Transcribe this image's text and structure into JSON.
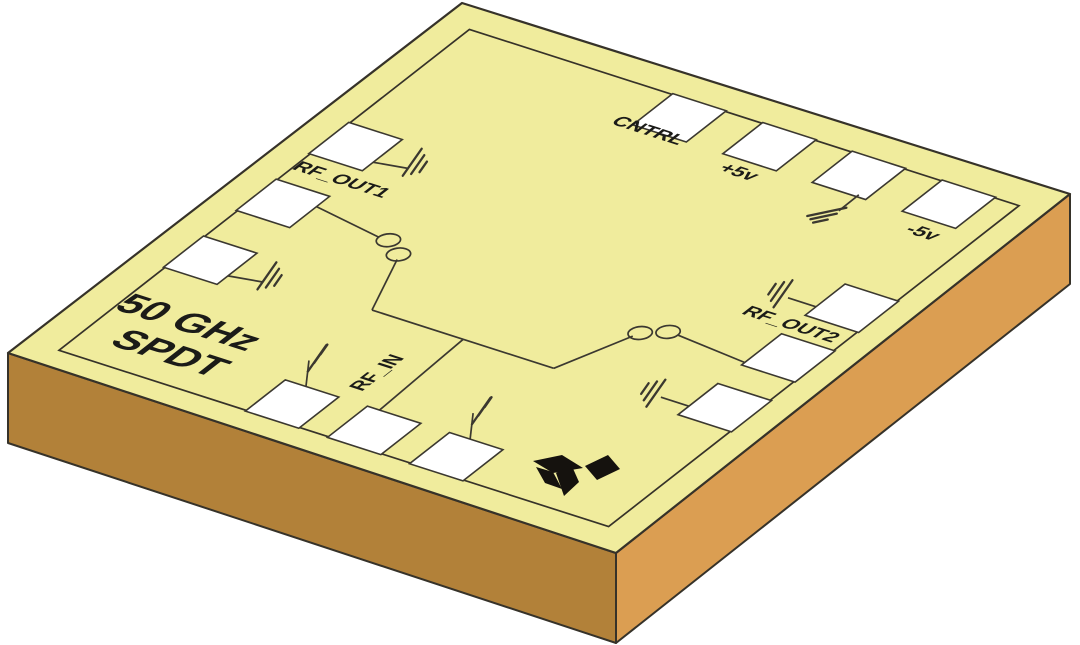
{
  "illustration": {
    "description": "Isometric rendering of a 50 GHz SPDT switch MMIC die on an orange substrate",
    "colors": {
      "background": "#ffffff",
      "die_top": "#f0ec9d",
      "substrate_left": "#b28139",
      "substrate_right": "#db9e52",
      "outline": "#363229",
      "pad_fill": "#ffffff",
      "pad_stroke": "#3b3830",
      "trace": "#3b3830",
      "text": "#1b1b18",
      "logo": "#15120e"
    },
    "die": {
      "top_face": [
        [
          462,
          3
        ],
        [
          1070,
          194
        ],
        [
          616,
          553
        ],
        [
          8,
          353
        ]
      ],
      "left_face": [
        [
          8,
          353
        ],
        [
          616,
          553
        ],
        [
          616,
          643
        ],
        [
          8,
          443
        ]
      ],
      "right_face": [
        [
          616,
          553
        ],
        [
          1070,
          194
        ],
        [
          1070,
          284
        ],
        [
          616,
          643
        ]
      ],
      "plane_matrix": [
        0.608,
        0.195,
        -0.454,
        0.355,
        462,
        3
      ],
      "border_inset": 48,
      "pad_size": 88,
      "circle_radius": 16
    },
    "pads": [
      {
        "id": "pad-cntrl",
        "edge": "top",
        "a": 425,
        "b": 90
      },
      {
        "id": "pad-plus5v",
        "edge": "top",
        "a": 573,
        "b": 90
      },
      {
        "id": "pad-gnd-top",
        "edge": "top",
        "a": 720,
        "b": 90
      },
      {
        "id": "pad-minus5v",
        "edge": "top",
        "a": 868,
        "b": 90
      },
      {
        "id": "pad-gnd-left-1",
        "edge": "left",
        "a": 90,
        "b": 355
      },
      {
        "id": "pad-rf-out1",
        "edge": "left",
        "a": 90,
        "b": 515
      },
      {
        "id": "pad-gnd-left-2",
        "edge": "left",
        "a": 90,
        "b": 675
      },
      {
        "id": "pad-gnd-bottom-1",
        "edge": "bottom",
        "a": 400,
        "b": 910
      },
      {
        "id": "pad-rf-in",
        "edge": "bottom",
        "a": 535,
        "b": 910
      },
      {
        "id": "pad-gnd-bottom-2",
        "edge": "bottom",
        "a": 670,
        "b": 910
      },
      {
        "id": "pad-gnd-right-1",
        "edge": "right",
        "a": 910,
        "b": 360
      },
      {
        "id": "pad-rf-out2",
        "edge": "right",
        "a": 910,
        "b": 500
      },
      {
        "id": "pad-gnd-right-2",
        "edge": "right",
        "a": 910,
        "b": 640
      }
    ],
    "labels": [
      {
        "id": "label-cntrl",
        "text": "CNTRL",
        "a": 408,
        "b": 137,
        "size": 33
      },
      {
        "id": "label-plus5v",
        "text": "+5v",
        "a": 575,
        "b": 162,
        "size": 33
      },
      {
        "id": "label-minus5v",
        "text": "-5v",
        "a": 880,
        "b": 165,
        "size": 33
      },
      {
        "id": "label-rf-out1",
        "text": "RF_OUT1",
        "a": 123,
        "b": 432,
        "size": 33
      },
      {
        "id": "label-rf-out2",
        "text": "RF_OUT2",
        "a": 863,
        "b": 433,
        "size": 33
      },
      {
        "id": "label-rf-in",
        "text": "RF_IN",
        "a": 454,
        "b": 793,
        "size": 33,
        "rotate": -90
      },
      {
        "id": "title-line-1",
        "text": "50 GHz",
        "a": 158,
        "b": 817,
        "size": 65
      },
      {
        "id": "title-line-2",
        "text": "SPDT",
        "a": 182,
        "b": 891,
        "size": 65
      }
    ],
    "switch_circuit": {
      "traces": [
        {
          "id": "trace-rfout1-to-contact",
          "pts": [
            [
              134,
              500
            ],
            [
              252,
              521
            ]
          ]
        },
        {
          "id": "trace-contact1-drop",
          "pts": [
            [
              307,
              554
            ],
            [
              353,
              671
            ]
          ]
        },
        {
          "id": "trace-bus",
          "pts": [
            [
              353,
              671
            ],
            [
              652,
              671
            ]
          ]
        },
        {
          "id": "trace-rfin-riser",
          "pts": [
            [
              503,
              671
            ],
            [
              511,
              866
            ]
          ]
        },
        {
          "id": "trace-contact2-drop",
          "pts": [
            [
              652,
              671
            ],
            [
              696,
              556
            ]
          ]
        },
        {
          "id": "trace-contact-to-rfout2",
          "pts": [
            [
              747,
              525
            ],
            [
              866,
              537
            ]
          ]
        }
      ],
      "contacts": [
        {
          "id": "contact-1a",
          "a": 268,
          "b": 521
        },
        {
          "id": "contact-1b",
          "a": 301,
          "b": 543
        },
        {
          "id": "contact-2a",
          "a": 700,
          "b": 545
        },
        {
          "id": "contact-2b",
          "a": 731,
          "b": 525
        }
      ]
    },
    "grounds": [
      {
        "id": "gnd-sym-top",
        "attach": [
          749,
          129
        ],
        "stem": [
          -20,
          16
        ],
        "angle": -12,
        "lens": [
          40,
          27,
          15
        ],
        "stack": [
          -3.2,
          4.6
        ],
        "off": [
          -12,
          1
        ]
      },
      {
        "id": "gnd-sym-left-1",
        "attach": [
          134,
          375
        ],
        "stem": [
          34,
          6
        ],
        "angle": -55,
        "lens": [
          33,
          23,
          13
        ],
        "stack": [
          5.5,
          2.3
        ],
        "off": [
          5,
          -6
        ]
      },
      {
        "id": "gnd-sym-left-2",
        "attach": [
          134,
          695
        ],
        "stem": [
          34,
          6
        ],
        "angle": -55,
        "lens": [
          33,
          23,
          13
        ],
        "stack": [
          5.5,
          2.3
        ],
        "off": [
          5,
          -6
        ]
      },
      {
        "id": "gnd-sym-bottom-1",
        "attach": [
          390,
          866
        ],
        "stem": [
          3,
          -26
        ],
        "angle": -55,
        "lens": [
          32,
          22,
          12
        ],
        "stack": [
          3.5,
          -4.5
        ],
        "off": [
          8,
          -2
        ]
      },
      {
        "id": "gnd-sym-bottom-2",
        "attach": [
          660,
          866
        ],
        "stem": [
          3,
          -26
        ],
        "angle": -55,
        "lens": [
          32,
          22,
          12
        ],
        "stack": [
          3.5,
          -4.5
        ],
        "off": [
          8,
          -2
        ]
      },
      {
        "id": "gnd-sym-right-1",
        "attach": [
          866,
          380
        ],
        "stem": [
          -28,
          -9
        ],
        "angle": -55,
        "lens": [
          33,
          23,
          13
        ],
        "stack": [
          -5.5,
          -2.3
        ],
        "off": [
          -5,
          -4
        ]
      },
      {
        "id": "gnd-sym-right-2",
        "attach": [
          866,
          660
        ],
        "stem": [
          -28,
          -9
        ],
        "angle": -55,
        "lens": [
          33,
          23,
          13
        ],
        "stack": [
          -5.5,
          -2.3
        ],
        "off": [
          -5,
          -4
        ]
      }
    ],
    "logo": {
      "petals": [
        [
          [
            533,
            461
          ],
          [
            562,
            455
          ],
          [
            583,
            468
          ],
          [
            553,
            473
          ]
        ],
        [
          [
            536,
            467
          ],
          [
            553,
            472
          ],
          [
            562,
            489
          ],
          [
            545,
            483
          ]
        ],
        [
          [
            556,
            473
          ],
          [
            571,
            464
          ],
          [
            579,
            482
          ],
          [
            564,
            496
          ]
        ],
        [
          [
            585,
            466
          ],
          [
            608,
            455
          ],
          [
            620,
            469
          ],
          [
            597,
            480
          ]
        ]
      ]
    }
  }
}
